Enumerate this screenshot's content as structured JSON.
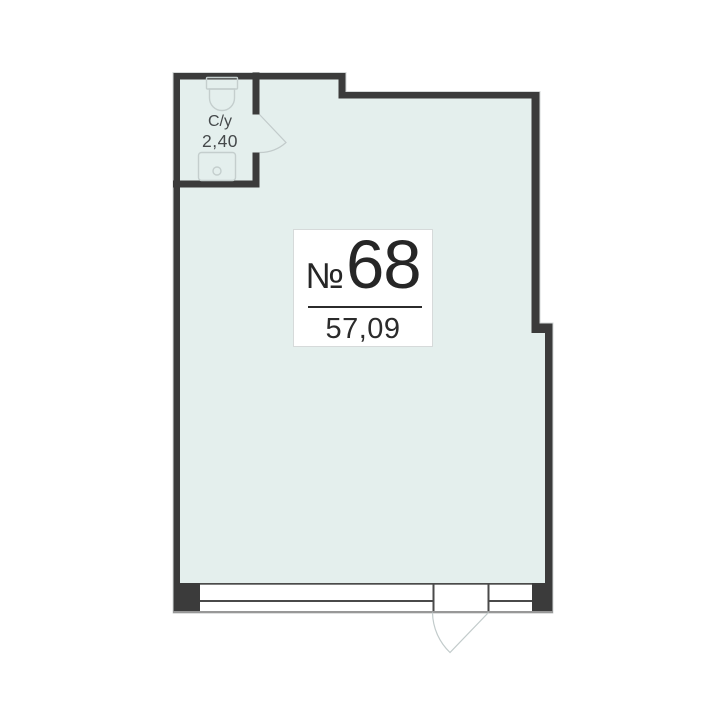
{
  "unit": {
    "number_sign": "№",
    "number": "68",
    "area": "57,09"
  },
  "bathroom": {
    "name": "С/у",
    "area": "2,40"
  },
  "colors": {
    "wall": "#3b3b3b",
    "floor": "#e4efed",
    "frame_line": "#4a4a4a",
    "outer_sill_line": "#989898",
    "fixture_line": "#c4cecd",
    "door_arc_line": "#c2cbcb",
    "label_border": "#d6dada",
    "label_text": "#262626",
    "bath_text": "#45494b"
  }
}
